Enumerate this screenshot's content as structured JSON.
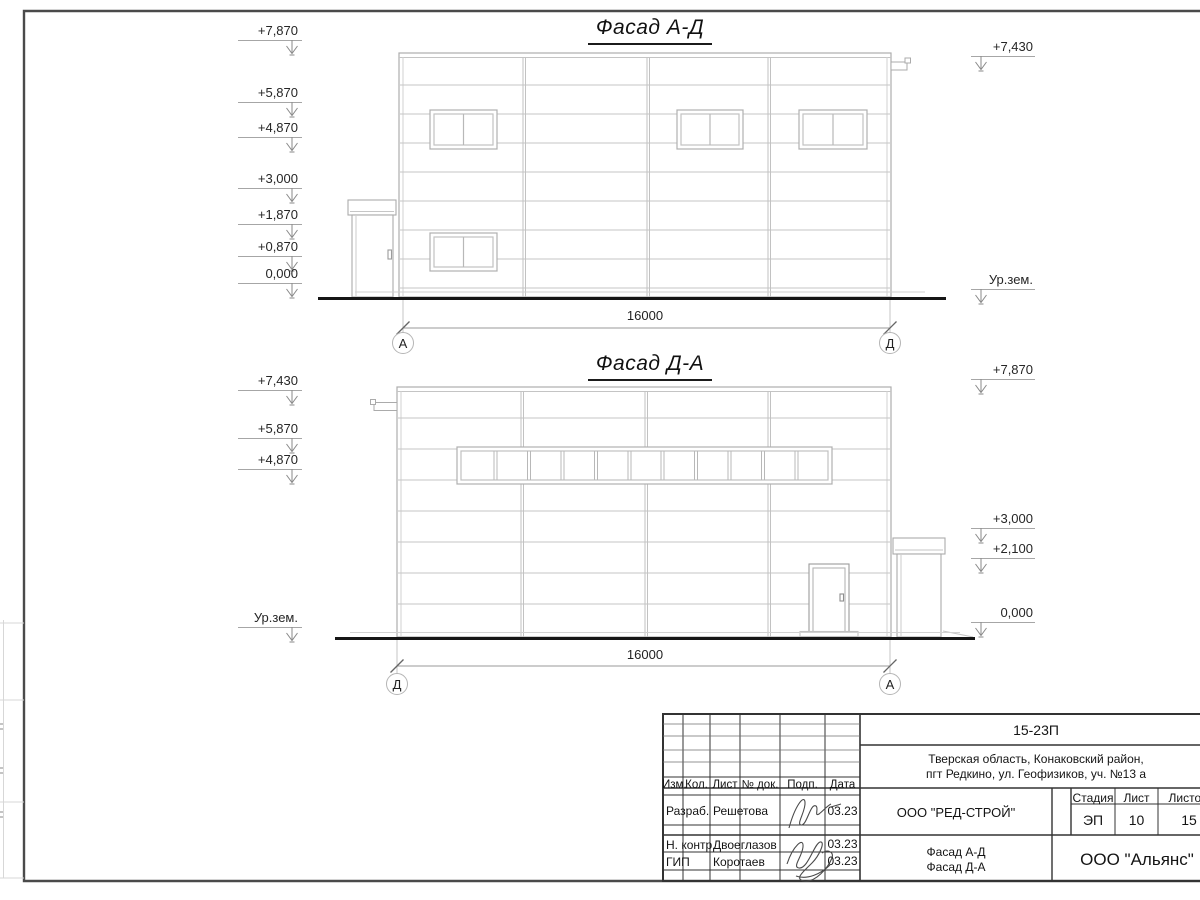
{
  "facade_top": {
    "title": "Фасад А-Д",
    "dimension": "16000",
    "axis_left": "А",
    "axis_right": "Д",
    "marks": {
      "m7870": "+7,870",
      "m5870": "+5,870",
      "m4870": "+4,870",
      "m3000": "+3,000",
      "m1870": "+1,870",
      "m0870": "+0,870",
      "m0000": "0,000",
      "right_top": "+7,430",
      "ground": "Ур.зем."
    }
  },
  "facade_bottom": {
    "title": "Фасад Д-А",
    "dimension": "16000",
    "axis_left": "Д",
    "axis_right": "А",
    "marks": {
      "m7430": "+7,430",
      "m5870": "+5,870",
      "m4870": "+4,870",
      "ground": "Ур.зем.",
      "r7870": "+7,870",
      "r3000": "+3,000",
      "r2100": "+2,100",
      "r0000": "0,000"
    }
  },
  "title_block": {
    "project_code": "15-23П",
    "address_line1": "Тверская область, Конаковский район,",
    "address_line2": "пгт Редкино, ул. Геофизиков, уч. №13 а",
    "col_izm": "Изм.",
    "col_kol": "Кол.",
    "col_list": "Лист",
    "col_doc": "№ док.",
    "col_podp": "Подп.",
    "col_data": "Дата",
    "rows": [
      {
        "role": "Разраб.",
        "name": "Решетова",
        "date": "03.23"
      },
      {
        "role": "Н. контр.",
        "name": "Двоеглазов",
        "date": "03.23"
      },
      {
        "role": "ГИП",
        "name": "Коротаев",
        "date": "03.23"
      }
    ],
    "company": "ООО \"РЕД-СТРОЙ\"",
    "stage_label": "Стадия",
    "sheet_label": "Лист",
    "sheets_label": "Листов",
    "stage": "ЭП",
    "sheet": "10",
    "sheets": "15",
    "drawing_name_line1": "Фасад А-Д",
    "drawing_name_line2": "Фасад Д-А",
    "contractor": "ООО \"Альянс\""
  }
}
